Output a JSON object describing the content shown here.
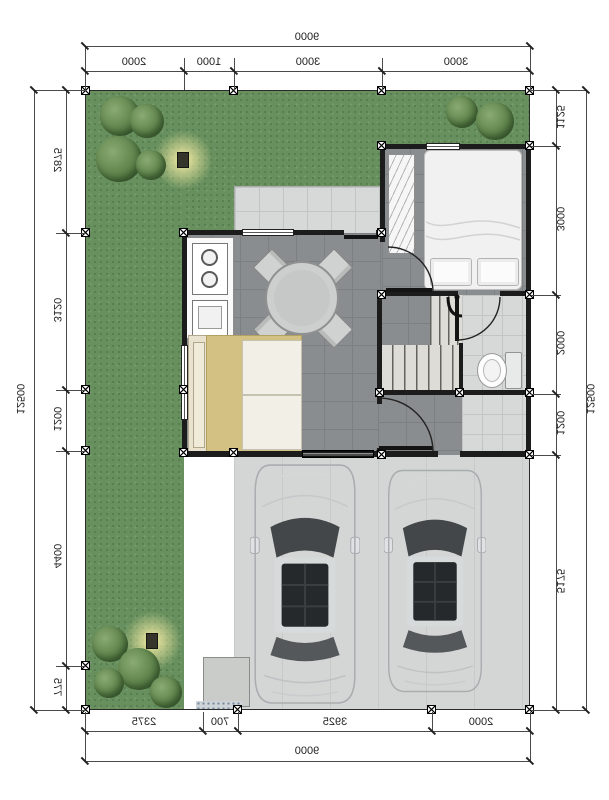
{
  "plan": {
    "title": "house-floor-plan-mirrored",
    "dimensions": {
      "top": {
        "total": "9000",
        "segments": [
          "2000",
          "1000",
          "3000",
          "3000"
        ]
      },
      "bottom": {
        "total": "9000",
        "segments": [
          "2375",
          "700",
          "3925",
          "2000"
        ]
      },
      "left": {
        "total": "12500",
        "segments": [
          "2875",
          "3120",
          "1200",
          "4400",
          "775"
        ]
      },
      "right": {
        "total": "12500",
        "segments": [
          "1125",
          "3000",
          "2000",
          "1200",
          "5175"
        ]
      }
    },
    "colors": {
      "grass": "#67905e",
      "interior_tile": "#8a8d90",
      "terrace_tile": "#d7d9d8",
      "carport_concrete": "#d3d6d4",
      "wall": "#1c1c1c",
      "bed_blanket": "#d3c083",
      "lamp_glow": "#fff3aa"
    }
  }
}
